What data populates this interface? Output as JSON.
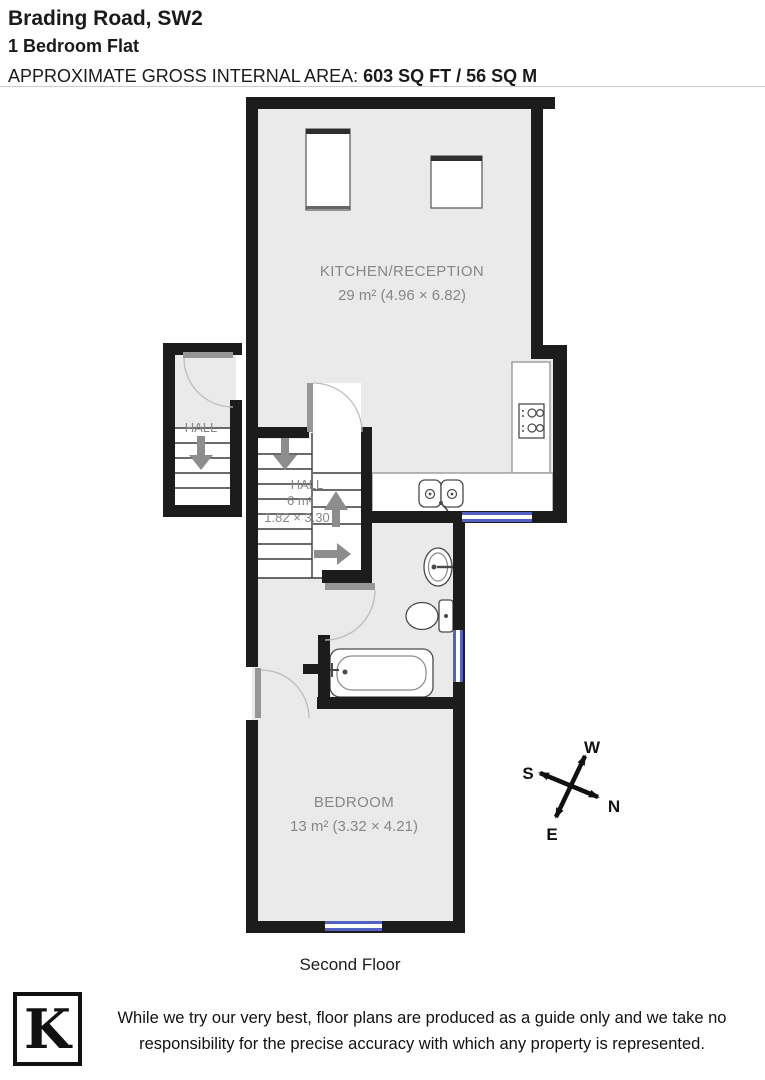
{
  "header": {
    "address": "Brading Road, SW2",
    "property_type": "1 Bedroom Flat",
    "area_label": "APPROXIMATE GROSS INTERNAL AREA:",
    "area_value": "603 SQ FT / 56 SQ M"
  },
  "floorplan": {
    "floor_label": "Second Floor",
    "kitchen": {
      "name": "KITCHEN/RECEPTION",
      "dims": "29 m² (4.96 × 6.82)"
    },
    "hall_upper": {
      "name": "HALL"
    },
    "hall_main": {
      "name": "HALL",
      "area": "6 m²",
      "dims": "1.82 × 3.30"
    },
    "bedroom": {
      "name": "BEDROOM",
      "dims": "13 m² (3.32 × 4.21)"
    },
    "compass": {
      "n": "N",
      "s": "S",
      "e": "E",
      "w": "W"
    }
  },
  "footer": {
    "logo_letter": "K",
    "disclaimer": "While we try our very best, floor plans are produced as a guide only and we take no responsibility for the precise accuracy with which any property is represented."
  },
  "colors": {
    "wall": "#1c1c1c",
    "floor": "#eaeaea",
    "window": "#5560c5",
    "label": "#878787",
    "arrow": "#8d8d8d"
  }
}
